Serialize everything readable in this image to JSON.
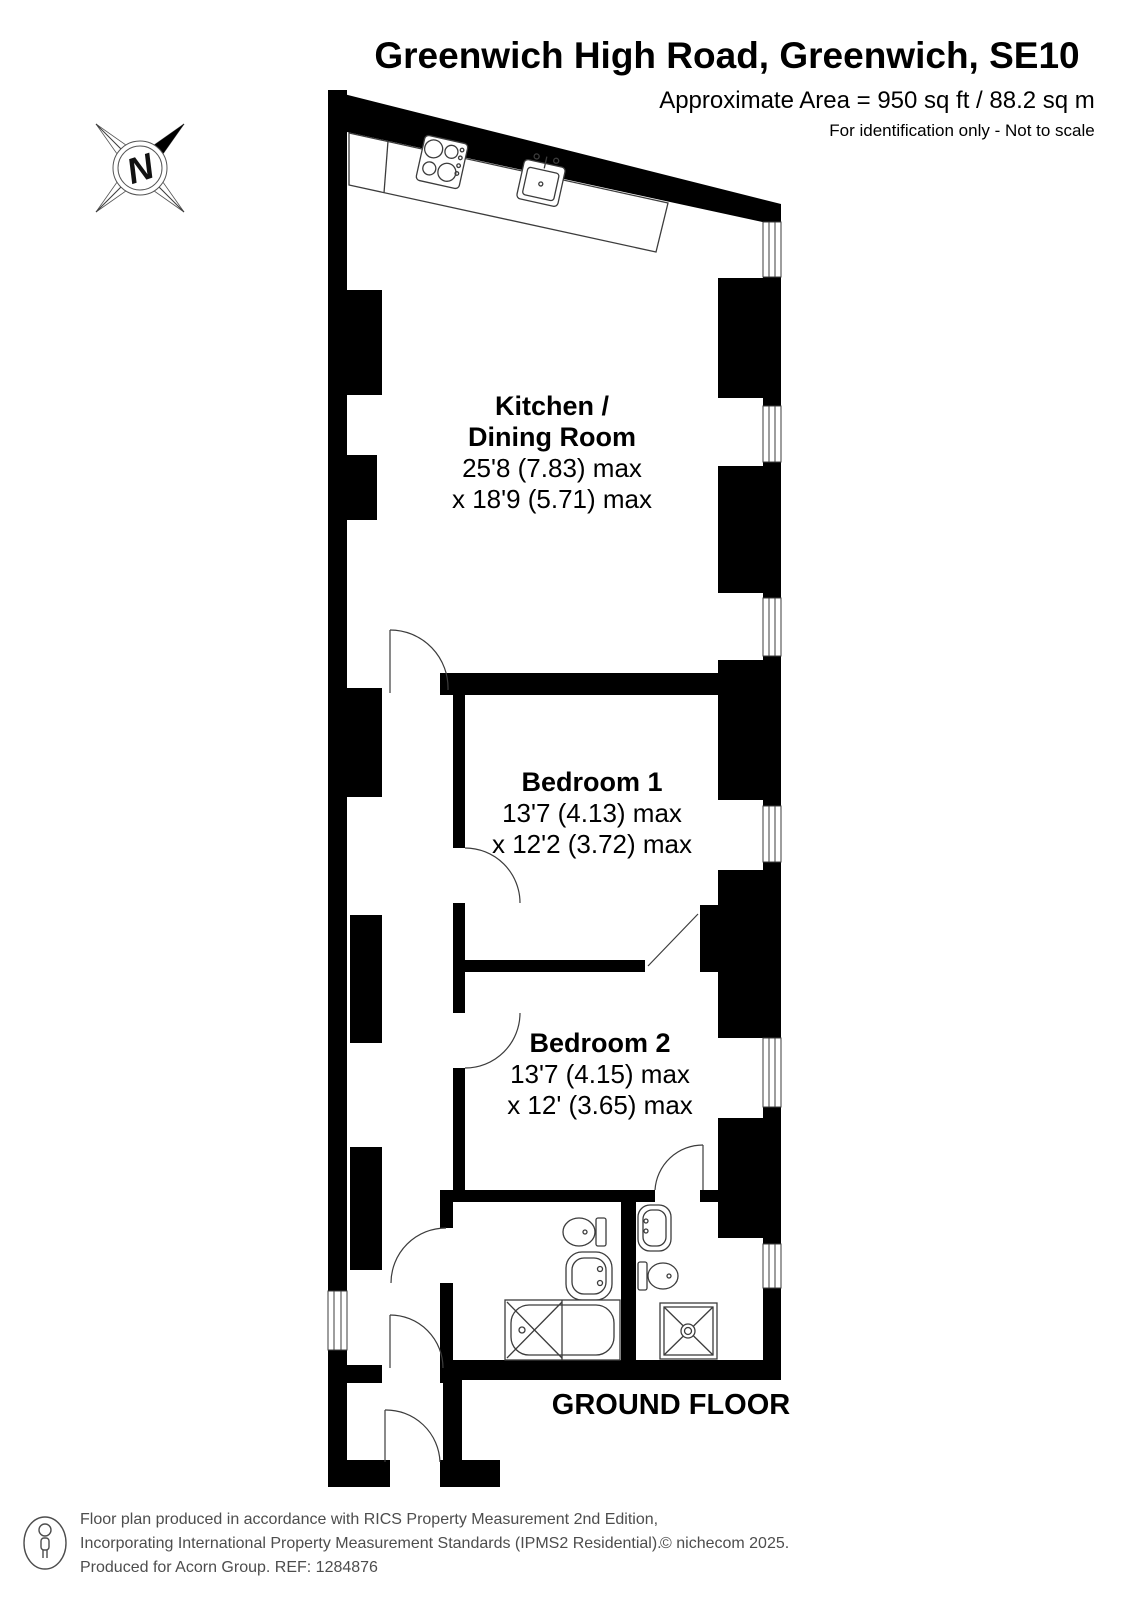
{
  "header": {
    "title": "Greenwich High Road, Greenwich, SE10",
    "area_line": "Approximate Area = 950 sq ft / 88.2 sq m",
    "disclaimer": "For identification only - Not to scale"
  },
  "compass": {
    "north_label": "N"
  },
  "rooms": {
    "kitchen": {
      "name_line1": "Kitchen /",
      "name_line2": "Dining Room",
      "dim_line1": "25'8 (7.83) max",
      "dim_line2": "x 18'9 (5.71) max"
    },
    "bedroom1": {
      "name": "Bedroom 1",
      "dim_line1": "13'7 (4.13) max",
      "dim_line2": "x 12'2 (3.72) max"
    },
    "bedroom2": {
      "name": "Bedroom 2",
      "dim_line1": "13'7 (4.15) max",
      "dim_line2": "x 12' (3.65) max"
    }
  },
  "floor_label": "GROUND FLOOR",
  "footer": {
    "line1": "Floor plan produced in accordance with RICS Property Measurement 2nd Edition,",
    "line2": "Incorporating International Property Measurement Standards (IPMS2 Residential).",
    "copyright": "© nichecom 2025.",
    "line3": "Produced for Acorn Group.   REF: 1284876"
  },
  "colors": {
    "wall": "#000000",
    "fixture_line": "#3c3c3c",
    "footer_text": "#4d4d4d",
    "background": "#ffffff"
  }
}
